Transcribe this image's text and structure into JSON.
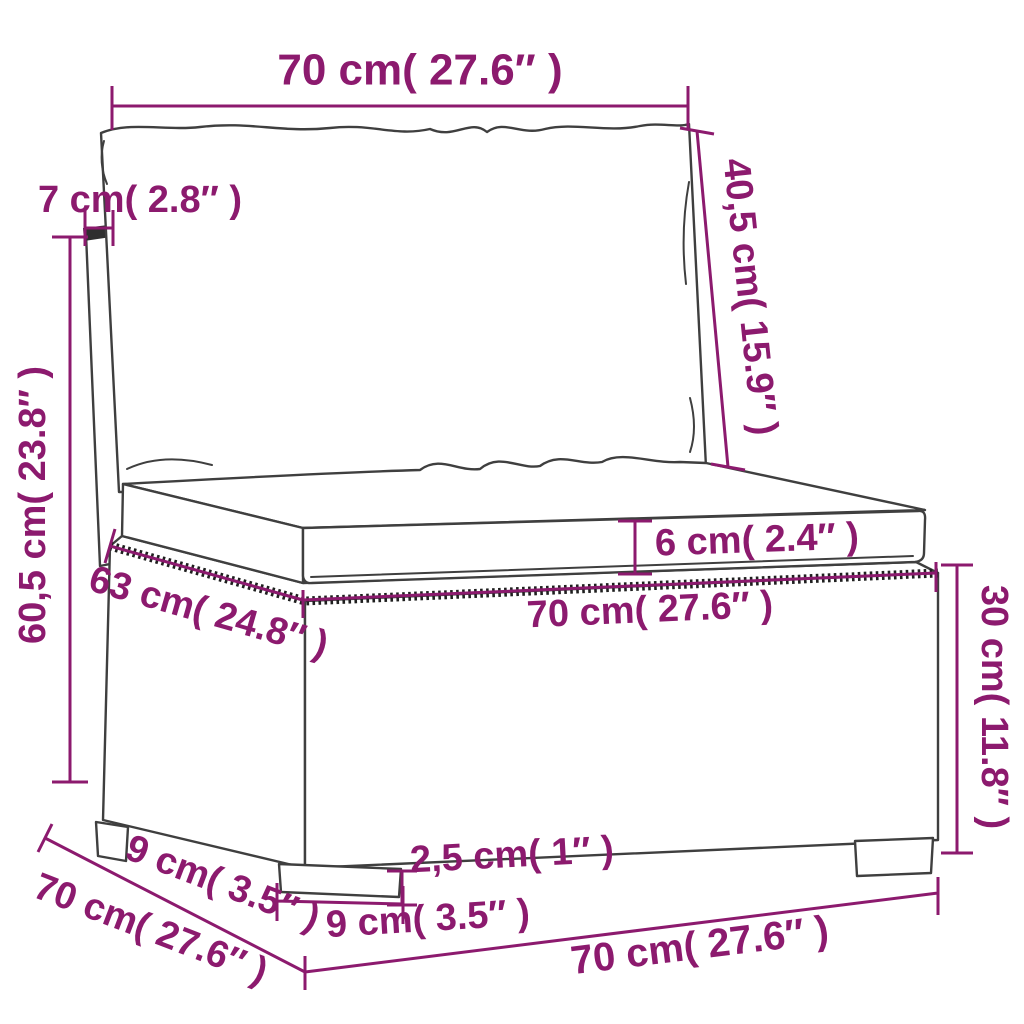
{
  "diagram": {
    "title": "rattan-sofa-section-dimension-diagram",
    "background_color": "#ffffff",
    "accent_color": "#8c1a6e",
    "outline_color": "#3f3f3f",
    "unit_style": "metric with imperial in parentheses",
    "dimensions": {
      "top_back_width": "70 cm( 27.6″ )",
      "back_cushion_height": "40,5 cm( 15.9″ )",
      "back_post_width": "7 cm( 2.8″ )",
      "total_height": "60,5 cm( 23.8″ )",
      "seat_cushion_thickness": "6 cm( 2.4″ )",
      "seat_front_width": "70 cm( 27.6″ )",
      "seat_depth": "63 cm( 24.8″ )",
      "base_height": "30 cm( 11.8″ )",
      "foot_height": "2,5 cm( 1″ )",
      "foot_depth": "9 cm( 3.5″ )",
      "side_foot_inset": "9 cm( 3.5″ )",
      "total_depth": "70 cm( 27.6″ )",
      "bottom_base_width": "70 cm( 27.6″ )"
    }
  }
}
